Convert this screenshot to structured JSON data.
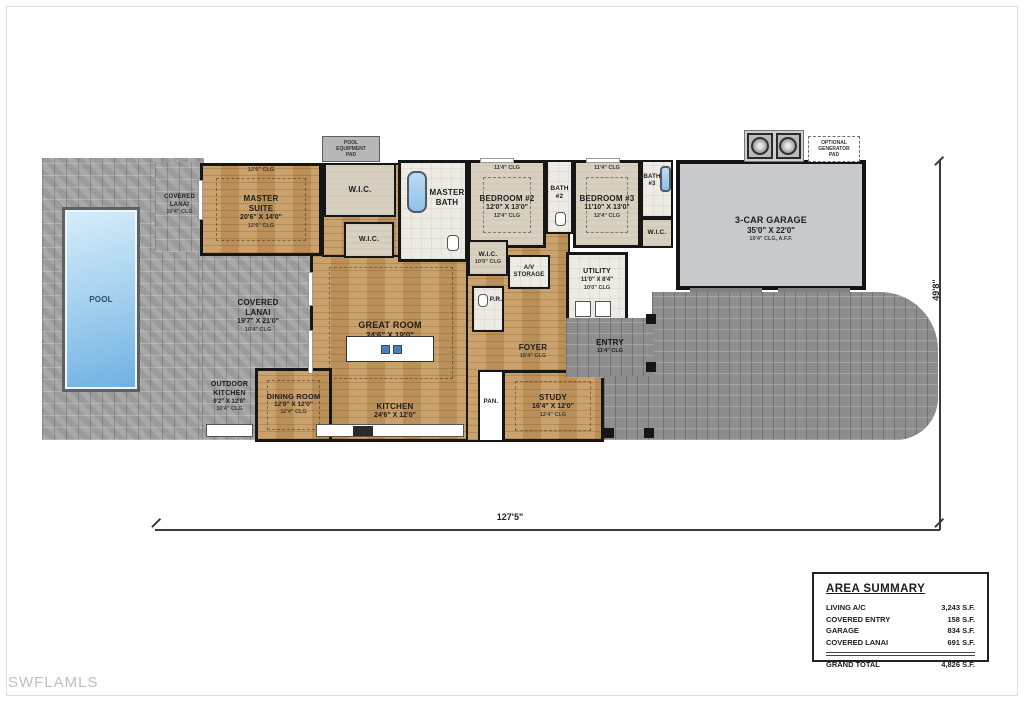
{
  "watermark": "SWFLAMLS",
  "dimensions": {
    "width_label": "127'5\"",
    "height_label": "49'8\""
  },
  "pads": {
    "pool_equipment": "POOL\nEQUIPMENT\nPAD",
    "generator": "OPTIONAL\nGENERATOR\nPAD"
  },
  "micro_labels": {
    "master_top_clg": "12'6\" CLG",
    "bedroom2_top_clg": "11'4\" CLG",
    "bedroom3_top_clg": "11'4\" CLG"
  },
  "rooms": {
    "pool": {
      "name": "POOL"
    },
    "lanai_small": {
      "name": "COVERED\nLANAI",
      "clg": "10'4\" CLG"
    },
    "lanai_big": {
      "name": "COVERED\nLANAI",
      "size": "19'7\" X 21'0\"",
      "clg": "10'4\" CLG"
    },
    "outdoor_kitchen": {
      "name": "OUTDOOR\nKITCHEN",
      "size": "9'2\" X 12'0\"",
      "clg": "10'4\" CLG"
    },
    "master_suite": {
      "name": "MASTER\nSUITE",
      "size": "20'6\" X 14'0\"",
      "clg": "12'6\" CLG"
    },
    "wic_top": {
      "name": "W.I.C."
    },
    "wic_lower": {
      "name": "W.I.C."
    },
    "master_bath": {
      "name": "MASTER\nBATH"
    },
    "bedroom2": {
      "name": "BEDROOM #2",
      "size": "12'0\" X 13'0\"",
      "clg": "12'4\" CLG"
    },
    "bath2": {
      "name": "BATH\n#2"
    },
    "bedroom3": {
      "name": "BEDROOM #3",
      "size": "11'10\" X 13'0\"",
      "clg": "12'4\" CLG"
    },
    "bath3": {
      "name": "BATH\n#3"
    },
    "wic3": {
      "name": "W.I.C."
    },
    "wic4": {
      "name": "W.I.C.",
      "clg": "10'0\" CLG"
    },
    "av_storage": {
      "name": "A/V\nSTORAGE"
    },
    "pr": {
      "name": "P.R."
    },
    "utility": {
      "name": "UTILITY",
      "size": "11'0\" X 8'4\"",
      "clg": "10'0\" CLG"
    },
    "foyer": {
      "name": "FOYER",
      "clg": "15'4\" CLG"
    },
    "entry": {
      "name": "ENTRY",
      "clg": "11'4\" CLG"
    },
    "great_room": {
      "name": "GREAT ROOM",
      "size": "24'6\" X 19'0\"",
      "clg": "13'4\" CLG"
    },
    "kitchen": {
      "name": "KITCHEN",
      "size": "24'6\" X 12'0\""
    },
    "pan": {
      "name": "PAN."
    },
    "dining": {
      "name": "DINING ROOM",
      "size": "12'0\" X 12'0\"",
      "clg": "12'4\" CLG"
    },
    "study": {
      "name": "STUDY",
      "size": "16'4\" X 12'0\"",
      "clg": "12'4\" CLG"
    },
    "garage": {
      "name": "3-CAR GARAGE",
      "size": "35'0\" X 22'0\"",
      "clg": "10'4\" CLG, A.F.F."
    }
  },
  "area_summary": {
    "title": "AREA SUMMARY",
    "rows": [
      {
        "label": "LIVING A/C",
        "value": "3,243 S.F."
      },
      {
        "label": "COVERED ENTRY",
        "value": "158 S.F."
      },
      {
        "label": "GARAGE",
        "value": "834 S.F."
      },
      {
        "label": "COVERED LANAI",
        "value": "691 S.F."
      }
    ],
    "total": {
      "label": "GRAND TOTAL",
      "value": "4,826 S.F."
    }
  }
}
